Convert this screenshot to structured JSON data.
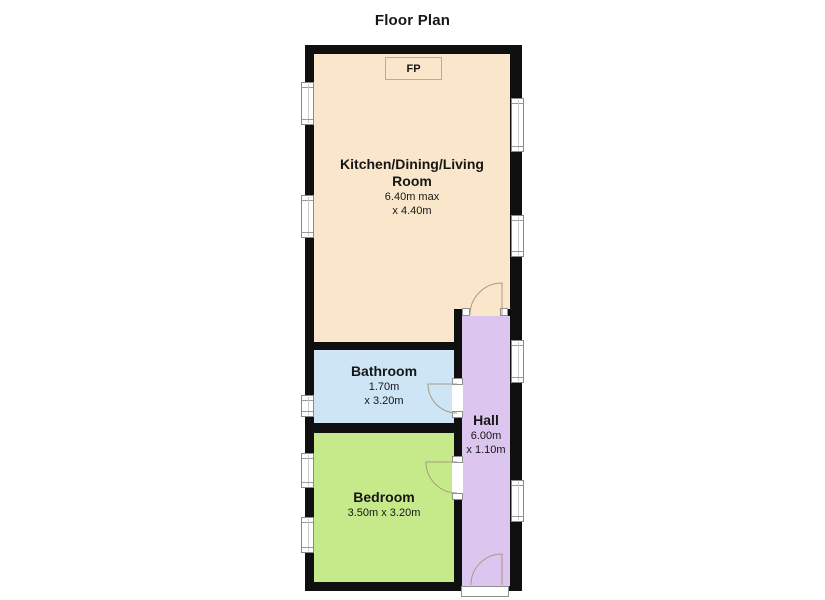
{
  "title": "Floor Plan",
  "colors": {
    "wall": "#0f0f0f",
    "kitchen": "#FAE7CB",
    "bathroom": "#CEE5F6",
    "bedroom": "#C6E98A",
    "hall": "#DCC6F0",
    "door_stroke": "#A69B83",
    "text": "#161616"
  },
  "fireplace": {
    "label": "FP"
  },
  "rooms": {
    "kitchen": {
      "name_line1": "Kitchen/Dining/Living",
      "name_line2": "Room",
      "dim_line1": "6.40m max",
      "dim_line2": "x 4.40m"
    },
    "bathroom": {
      "name": "Bathroom",
      "dim_line1": "1.70m",
      "dim_line2": "x 3.20m"
    },
    "bedroom": {
      "name": "Bedroom",
      "dim_line1": "3.50m x 3.20m"
    },
    "hall": {
      "name": "Hall",
      "dim_line1": "6.00m",
      "dim_line2": "x 1.10m"
    }
  }
}
